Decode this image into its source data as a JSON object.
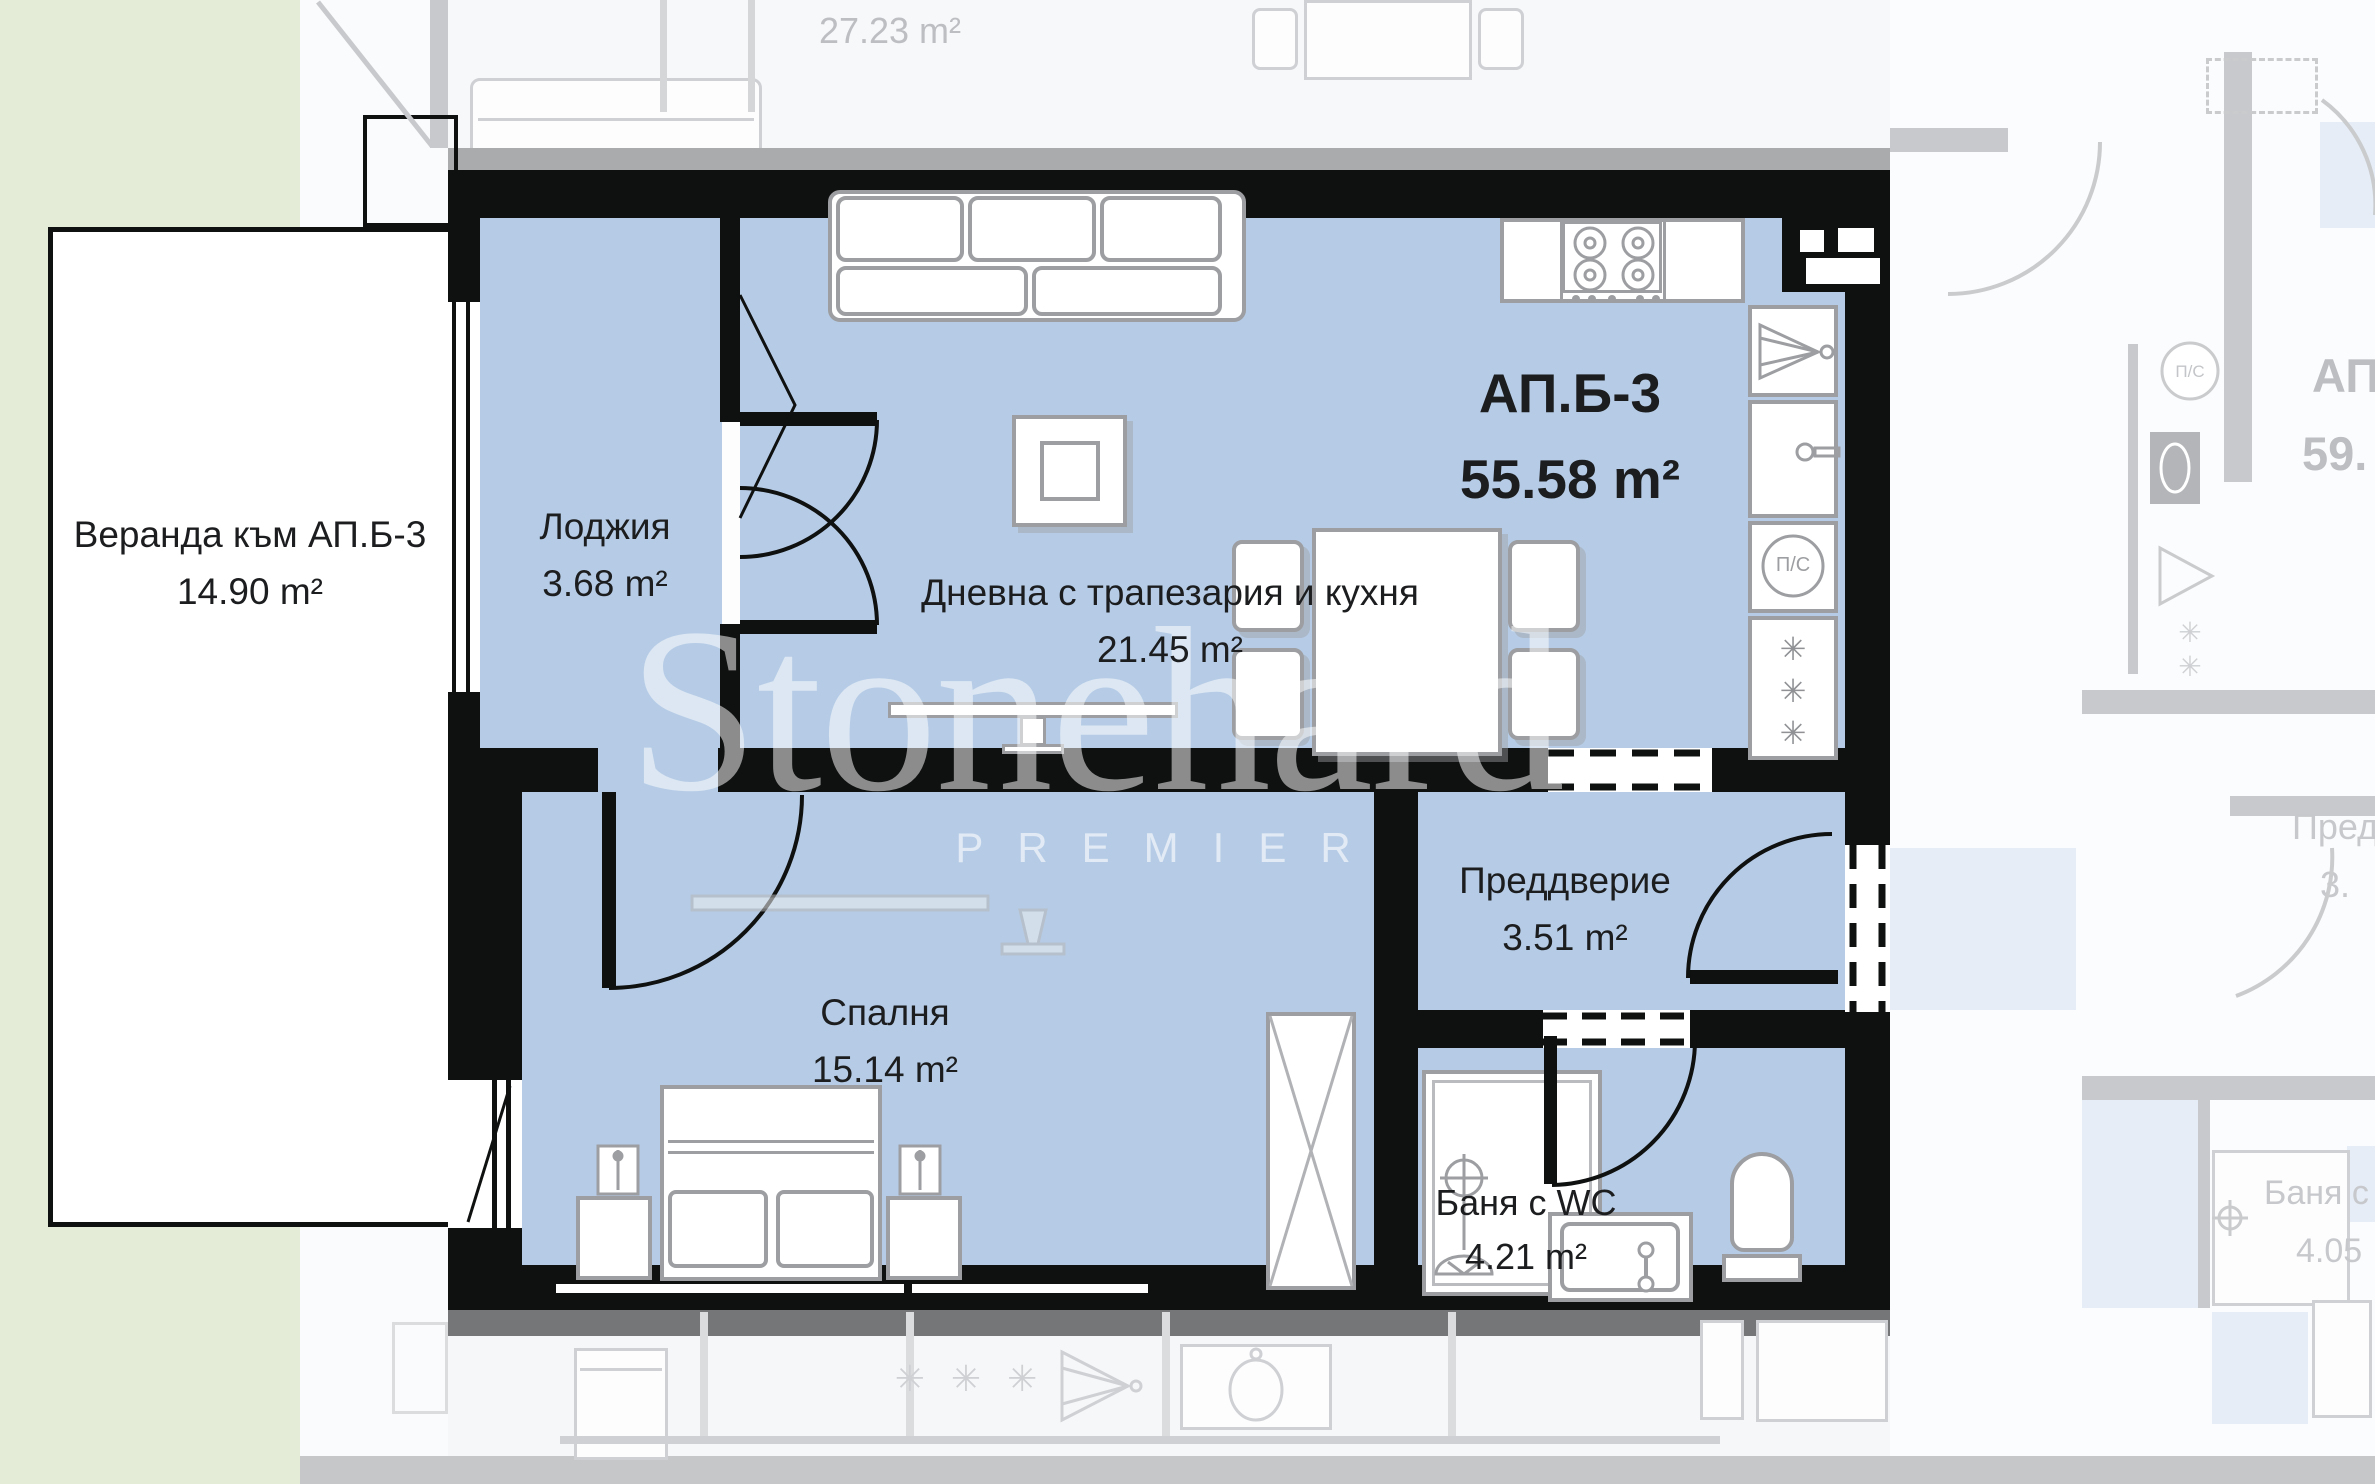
{
  "apartment": {
    "name": "АП.Б-3",
    "area": "55.58 m²"
  },
  "rooms": {
    "veranda": {
      "name": "Веранда към АП.Б-3",
      "area": "14.90 m²"
    },
    "loggia": {
      "name": "Лоджия",
      "area": "3.68 m²"
    },
    "living": {
      "name": "Дневна с трапезария и кухня",
      "area": "21.45 m²"
    },
    "bedroom": {
      "name": "Спалня",
      "area": "15.14 m²"
    },
    "hall": {
      "name": "Преддверие",
      "area": "3.51 m²"
    },
    "bath": {
      "name": "Баня с WC",
      "area": "4.21 m²"
    }
  },
  "neighbors": {
    "above": {
      "area": "27.23 m²"
    },
    "right_apartment": {
      "name": "АП",
      "area": "59."
    },
    "right_hall": {
      "name": "Пред",
      "area": "3."
    },
    "right_bath": {
      "name": "Баня с",
      "area": "4.05"
    }
  },
  "appliances": {
    "washer_label": "П/С",
    "neighbor_washer_label": "П/С",
    "fridge_star": "✳",
    "neighbor_star": "✳",
    "lower_floor_stars": "✳ ✳ ✳"
  },
  "watermark": {
    "brand": "Stonehard",
    "tier": "PREMIER"
  },
  "colors": {
    "room_fill": "#b6cce6",
    "wall": "#0f1010",
    "garden": "#e4ebd6",
    "faded_line": "#c7c9cc",
    "faded_text": "#bcbec2",
    "label_text": "#1c1d1f",
    "furniture_line": "#9c9ea1"
  }
}
